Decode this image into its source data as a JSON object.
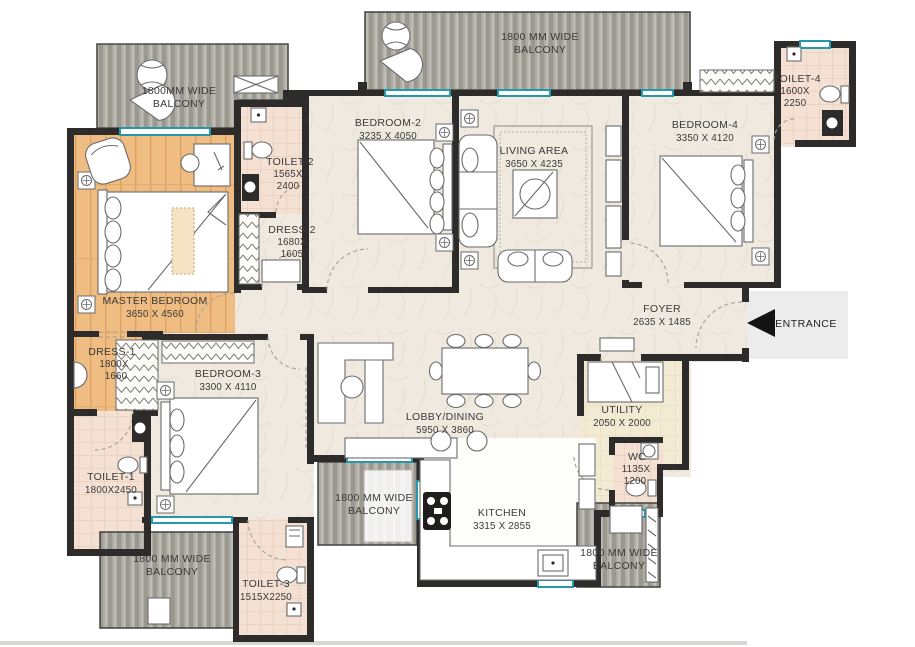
{
  "plan": {
    "entrance_label": "ENTRANCE",
    "colors": {
      "wall": "#2e2c2a",
      "window_teal": "#2598ac",
      "wood_floor": "#efbc82",
      "tile_floor": "#f5e1d4",
      "deck_floor": "#aeaca5",
      "marble_floor": "#efe9df",
      "utility_floor": "#f2ead2",
      "entrance_pad": "#ececec"
    },
    "rooms": {
      "balcony_tl": {
        "line1": "1800MM WIDE",
        "line2": "BALCONY"
      },
      "balcony_tc": {
        "line1": "1800 MM WIDE",
        "line2": "BALCONY"
      },
      "balcony_bl": {
        "line1": "1800 MM WIDE",
        "line2": "BALCONY"
      },
      "balcony_bc": {
        "line1": "1800 MM WIDE",
        "line2": "BALCONY"
      },
      "balcony_br": {
        "line1": "1800 MM WIDE",
        "line2": "BALCONY"
      },
      "master": {
        "line1": "MASTER BEDROOM",
        "line2": "3650 X 4560"
      },
      "bedroom2": {
        "line1": "BEDROOM-2",
        "line2": "3235 X 4050"
      },
      "bedroom3": {
        "line1": "BEDROOM-3",
        "line2": "3300 X 4110"
      },
      "bedroom4": {
        "line1": "BEDROOM-4",
        "line2": "3350 X 4120"
      },
      "living": {
        "line1": "LIVING AREA",
        "line2": "3650 X 4235"
      },
      "lobby": {
        "line1": "LOBBY/DINING",
        "line2": "5950 X 3860"
      },
      "kitchen": {
        "line1": "KITCHEN",
        "line2": "3315 X 2855"
      },
      "foyer": {
        "line1": "FOYER",
        "line2": "2635 X 1485"
      },
      "utility": {
        "line1": "UTILITY",
        "line2": "2050 X 2000"
      },
      "wc": {
        "line1": "WC",
        "line2": "1135X",
        "line3": "1200"
      },
      "toilet1": {
        "line1": "TOILET-1",
        "line2": "1800X2450"
      },
      "toilet2": {
        "line1": "TOILET-2",
        "line2": "1565X",
        "line3": "2400"
      },
      "toilet3": {
        "line1": "TOILET-3",
        "line2": "1515X2250"
      },
      "toilet4": {
        "line1": "TOILET-4",
        "line2": "1600X",
        "line3": "2250"
      },
      "dress1": {
        "line1": "DRESS-1",
        "line2": "1800X",
        "line3": "1660"
      },
      "dress2": {
        "line1": "DRESS-2",
        "line2": "1680X",
        "line3": "1605"
      }
    }
  }
}
